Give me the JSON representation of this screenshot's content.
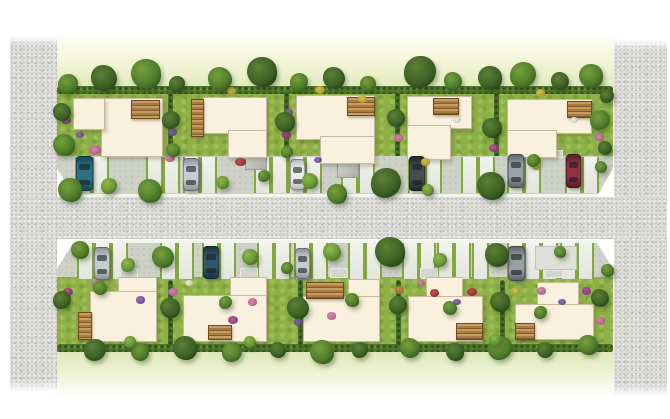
{
  "meta": {
    "type": "architectural-site-plan-illustration",
    "description": "Top-down watercolor-style masterplan of a residential development: two rows of five detached houses with gardens, wooden decks, street trees, flower beds, parking bays and a central gravel road flanked by two vertical gravel strips.",
    "house_count": 10,
    "car_count": 10
  },
  "palette": {
    "background": "#ffffff",
    "house_fill": "#f9f0dd",
    "deck_brown": "#a87c42",
    "grass_green": "#8fb047",
    "hedge_green": "#3c6124",
    "gravel_gray": "#dbdbd8",
    "pavement_gray": "#cdd1c6",
    "curb_white": "#f5f5f0",
    "cars": {
      "teal": {
        "body": "#2e7080",
        "dark": "#174a56"
      },
      "silver": {
        "body": "#c7cbcd",
        "dark": "#8f9598"
      },
      "white": {
        "body": "#e9ebe9",
        "dark": "#b9bdbc"
      },
      "black": {
        "body": "#474c4f",
        "dark": "#232729"
      },
      "gray": {
        "body": "#9aa1a4",
        "dark": "#5f676b"
      },
      "darkred": {
        "body": "#8e3342",
        "dark": "#5a1c28"
      },
      "darkblue": {
        "body": "#31566e",
        "dark": "#1b3344"
      }
    },
    "flowers": {
      "pink": {
        "c": "#d886b4",
        "d": "#a9527f"
      },
      "magenta": {
        "c": "#b5519b",
        "d": "#7e2f6b"
      },
      "red": {
        "c": "#c2484a",
        "d": "#8a2527"
      },
      "yellow": {
        "c": "#ddc54a",
        "d": "#a88f26"
      },
      "white": {
        "c": "#eff0e4",
        "d": "#bcbfae"
      },
      "purple": {
        "c": "#8f6cb0",
        "d": "#5f4080"
      },
      "orange": {
        "c": "#cf8a44",
        "d": "#9a5f22"
      }
    }
  },
  "scene": {
    "canvas": {
      "w": 670,
      "h": 419
    },
    "meadows": {
      "top": [
        57,
        36,
        557,
        56
      ],
      "bottom": [
        57,
        348,
        557,
        49
      ]
    },
    "strips": {
      "left": [
        10,
        36,
        47,
        356
      ],
      "right": [
        614,
        40,
        53,
        356
      ]
    },
    "road": [
      10,
      197,
      657,
      42
    ],
    "grass_bands": {
      "top": [
        57,
        88,
        556,
        72
      ],
      "bottom": [
        57,
        277,
        556,
        75
      ]
    },
    "hedgerows": {
      "top": [
        57,
        86,
        556,
        8
      ],
      "bottom": [
        57,
        344,
        556,
        8
      ]
    },
    "hedge_dividers": {
      "top": {
        "y": 92,
        "h": 66,
        "w": 5,
        "xs": [
          168,
          284,
          395,
          494
        ]
      },
      "bottom": {
        "y": 280,
        "h": 66,
        "w": 5,
        "xs": [
          168,
          298,
          396,
          500
        ]
      }
    },
    "pavements": {
      "top": {
        "rect": [
          57,
          156,
          556,
          41
        ],
        "clip": "polygon(0 0, 100% 0, 100% 30%, 97.1% 100%, 3.2% 100%, 0 30%)",
        "curb": "bottom"
      },
      "bottom": {
        "rect": [
          57,
          240,
          556,
          41
        ],
        "clip": "polygon(3.2% 0, 96.8% 0, 100% 70%, 100% 100%, 0 100%, 0 70%)",
        "curb": "top"
      }
    },
    "parking_pads": {
      "top": {
        "y": 157,
        "h": 36,
        "w": 13,
        "xs": [
          75,
          92,
          146,
          163,
          183,
          200,
          254,
          271,
          288,
          305,
          341,
          358,
          408,
          425,
          461,
          478,
          507,
          524,
          565,
          582
        ]
      },
      "bottom": {
        "y": 243,
        "h": 36,
        "w": 13,
        "xs": [
          77,
          94,
          111,
          160,
          177,
          202,
          219,
          257,
          274,
          294,
          311,
          348,
          365,
          402,
          419,
          437,
          454,
          472,
          507,
          524,
          541,
          560,
          577
        ]
      }
    },
    "walkways": [
      [
        128,
        147,
        20,
        10
      ],
      [
        243,
        145,
        18,
        12
      ],
      [
        333,
        150,
        18,
        8
      ],
      [
        430,
        150,
        18,
        8
      ],
      [
        545,
        150,
        18,
        8
      ],
      [
        120,
        268,
        18,
        10
      ],
      [
        240,
        268,
        18,
        10
      ],
      [
        330,
        268,
        18,
        10
      ],
      [
        420,
        268,
        18,
        10
      ],
      [
        545,
        270,
        18,
        8
      ]
    ],
    "sheds": [
      [
        245,
        150,
        20,
        18
      ],
      [
        337,
        158,
        20,
        18
      ]
    ],
    "patios": [
      [
        535,
        246,
        40,
        22
      ]
    ],
    "houses": [
      {
        "id": "house-top-1",
        "parts": [
          [
            101,
            98,
            60,
            57
          ],
          [
            73,
            98,
            30,
            30
          ]
        ],
        "deck": [
          131,
          100,
          27,
          17
        ]
      },
      {
        "id": "house-top-2",
        "parts": [
          [
            203,
            97,
            62,
            35
          ],
          [
            228,
            130,
            37,
            26
          ]
        ],
        "deck": [
          191,
          99,
          11,
          36
        ]
      },
      {
        "id": "house-top-3",
        "parts": [
          [
            296,
            95,
            77,
            43
          ],
          [
            320,
            136,
            53,
            26
          ]
        ],
        "deck": [
          347,
          97,
          26,
          17
        ]
      },
      {
        "id": "house-top-4",
        "parts": [
          [
            407,
            96,
            63,
            31
          ],
          [
            407,
            125,
            42,
            33
          ]
        ],
        "deck": [
          433,
          98,
          24,
          15
        ]
      },
      {
        "id": "house-top-5",
        "parts": [
          [
            507,
            99,
            83,
            33
          ],
          [
            507,
            130,
            48,
            26
          ]
        ],
        "deck": [
          567,
          101,
          23,
          15
        ]
      },
      {
        "id": "house-bottom-1",
        "parts": [
          [
            118,
            277,
            37,
            18
          ],
          [
            90,
            291,
            65,
            49
          ]
        ],
        "deck": [
          78,
          312,
          12,
          26
        ]
      },
      {
        "id": "house-bottom-2",
        "parts": [
          [
            230,
            277,
            35,
            22
          ],
          [
            183,
            295,
            82,
            45
          ]
        ],
        "deck": [
          208,
          325,
          22,
          13
        ]
      },
      {
        "id": "house-bottom-3",
        "parts": [
          [
            348,
            279,
            30,
            21
          ],
          [
            303,
            296,
            75,
            44
          ]
        ],
        "deck": [
          306,
          282,
          36,
          15
        ]
      },
      {
        "id": "house-bottom-4",
        "parts": [
          [
            426,
            277,
            35,
            23
          ],
          [
            408,
            296,
            73,
            44
          ]
        ],
        "deck": [
          456,
          323,
          25,
          15
        ]
      },
      {
        "id": "house-bottom-5",
        "parts": [
          [
            537,
            282,
            40,
            24
          ],
          [
            515,
            304,
            77,
            34
          ]
        ],
        "deck": [
          515,
          323,
          18,
          15
        ]
      }
    ],
    "cars": [
      [
        76,
        156,
        15,
        33,
        "teal"
      ],
      [
        183,
        158,
        14,
        31,
        "silver"
      ],
      [
        290,
        159,
        13,
        29,
        "white"
      ],
      [
        409,
        156,
        14,
        33,
        "black"
      ],
      [
        508,
        154,
        14,
        32,
        "gray"
      ],
      [
        566,
        154,
        13,
        32,
        "darkred"
      ],
      [
        94,
        247,
        14,
        31,
        "silver"
      ],
      [
        203,
        246,
        14,
        31,
        "darkblue"
      ],
      [
        295,
        248,
        13,
        29,
        "silver"
      ],
      [
        508,
        246,
        15,
        33,
        "gray"
      ]
    ],
    "flowers": [
      [
        66,
        120,
        10,
        "magenta"
      ],
      [
        95,
        150,
        12,
        "pink"
      ],
      [
        80,
        135,
        8,
        "purple"
      ],
      [
        172,
        132,
        9,
        "purple"
      ],
      [
        170,
        158,
        10,
        "pink"
      ],
      [
        240,
        162,
        11,
        "red"
      ],
      [
        231,
        91,
        9,
        "yellow"
      ],
      [
        286,
        135,
        9,
        "magenta"
      ],
      [
        289,
        112,
        8,
        "purple"
      ],
      [
        320,
        90,
        10,
        "yellow"
      ],
      [
        362,
        99,
        9,
        "yellow"
      ],
      [
        398,
        138,
        9,
        "pink"
      ],
      [
        425,
        162,
        9,
        "yellow"
      ],
      [
        457,
        120,
        8,
        "white"
      ],
      [
        494,
        148,
        10,
        "magenta"
      ],
      [
        540,
        93,
        9,
        "yellow"
      ],
      [
        574,
        120,
        8,
        "white"
      ],
      [
        599,
        137,
        9,
        "pink"
      ],
      [
        318,
        160,
        8,
        "purple"
      ],
      [
        536,
        166,
        9,
        "yellow"
      ],
      [
        68,
        292,
        10,
        "magenta"
      ],
      [
        96,
        284,
        9,
        "pink"
      ],
      [
        140,
        300,
        9,
        "purple"
      ],
      [
        173,
        292,
        10,
        "pink"
      ],
      [
        189,
        283,
        8,
        "white"
      ],
      [
        233,
        320,
        10,
        "magenta"
      ],
      [
        252,
        302,
        9,
        "pink"
      ],
      [
        298,
        322,
        9,
        "purple"
      ],
      [
        331,
        316,
        9,
        "pink"
      ],
      [
        354,
        302,
        9,
        "magenta"
      ],
      [
        399,
        290,
        9,
        "orange"
      ],
      [
        421,
        283,
        8,
        "pink"
      ],
      [
        434,
        293,
        9,
        "red"
      ],
      [
        472,
        292,
        10,
        "red"
      ],
      [
        457,
        302,
        8,
        "purple"
      ],
      [
        541,
        291,
        9,
        "pink"
      ],
      [
        562,
        302,
        8,
        "purple"
      ],
      [
        586,
        291,
        9,
        "magenta"
      ],
      [
        600,
        321,
        9,
        "pink"
      ],
      [
        516,
        291,
        8,
        "yellow"
      ]
    ],
    "trees": [
      [
        68,
        84,
        20,
        1
      ],
      [
        104,
        78,
        26,
        0
      ],
      [
        146,
        74,
        30,
        1
      ],
      [
        177,
        84,
        16,
        0
      ],
      [
        220,
        79,
        24,
        1
      ],
      [
        262,
        72,
        30,
        0
      ],
      [
        299,
        82,
        18,
        1
      ],
      [
        334,
        78,
        22,
        0
      ],
      [
        368,
        84,
        16,
        1
      ],
      [
        420,
        72,
        32,
        0
      ],
      [
        453,
        81,
        18,
        1
      ],
      [
        490,
        78,
        24,
        0
      ],
      [
        523,
        75,
        26,
        1
      ],
      [
        560,
        81,
        18,
        0
      ],
      [
        591,
        76,
        24,
        1
      ],
      [
        607,
        96,
        14,
        0
      ],
      [
        62,
        112,
        18,
        0
      ],
      [
        64,
        145,
        22,
        1
      ],
      [
        171,
        120,
        18,
        0
      ],
      [
        173,
        150,
        14,
        1
      ],
      [
        285,
        122,
        20,
        0
      ],
      [
        287,
        152,
        12,
        1
      ],
      [
        396,
        118,
        18,
        0
      ],
      [
        492,
        128,
        20,
        0
      ],
      [
        600,
        120,
        20,
        1
      ],
      [
        605,
        148,
        14,
        0
      ],
      [
        70,
        190,
        24,
        1
      ],
      [
        109,
        186,
        16,
        2
      ],
      [
        150,
        191,
        24,
        1
      ],
      [
        222,
        182,
        13,
        2
      ],
      [
        264,
        176,
        12,
        1
      ],
      [
        310,
        181,
        16,
        2
      ],
      [
        337,
        194,
        20,
        1
      ],
      [
        386,
        183,
        30,
        0
      ],
      [
        428,
        190,
        12,
        2
      ],
      [
        491,
        186,
        28,
        0
      ],
      [
        533,
        160,
        13,
        1
      ],
      [
        601,
        167,
        12,
        1
      ],
      [
        80,
        250,
        18,
        1
      ],
      [
        128,
        265,
        14,
        2
      ],
      [
        163,
        257,
        22,
        1
      ],
      [
        250,
        257,
        16,
        2
      ],
      [
        287,
        268,
        12,
        1
      ],
      [
        332,
        252,
        18,
        2
      ],
      [
        390,
        252,
        30,
        0
      ],
      [
        440,
        260,
        14,
        2
      ],
      [
        497,
        255,
        24,
        0
      ],
      [
        560,
        252,
        12,
        1
      ],
      [
        62,
        300,
        18,
        0
      ],
      [
        100,
        288,
        14,
        1
      ],
      [
        170,
        308,
        20,
        0
      ],
      [
        225,
        302,
        13,
        1
      ],
      [
        298,
        308,
        22,
        0
      ],
      [
        352,
        300,
        14,
        1
      ],
      [
        398,
        305,
        18,
        0
      ],
      [
        450,
        308,
        14,
        1
      ],
      [
        500,
        302,
        20,
        0
      ],
      [
        540,
        312,
        13,
        1
      ],
      [
        600,
        298,
        18,
        0
      ],
      [
        607,
        270,
        13,
        1
      ],
      [
        95,
        350,
        22,
        0
      ],
      [
        140,
        352,
        18,
        1
      ],
      [
        185,
        348,
        24,
        0
      ],
      [
        232,
        352,
        20,
        1
      ],
      [
        278,
        350,
        16,
        0
      ],
      [
        322,
        352,
        24,
        1
      ],
      [
        360,
        350,
        16,
        0
      ],
      [
        410,
        348,
        20,
        1
      ],
      [
        455,
        352,
        18,
        0
      ],
      [
        500,
        348,
        24,
        1
      ],
      [
        545,
        350,
        16,
        0
      ],
      [
        588,
        345,
        20,
        1
      ],
      [
        130,
        342,
        12,
        2
      ],
      [
        250,
        342,
        12,
        2
      ],
      [
        495,
        340,
        12,
        2
      ]
    ]
  }
}
